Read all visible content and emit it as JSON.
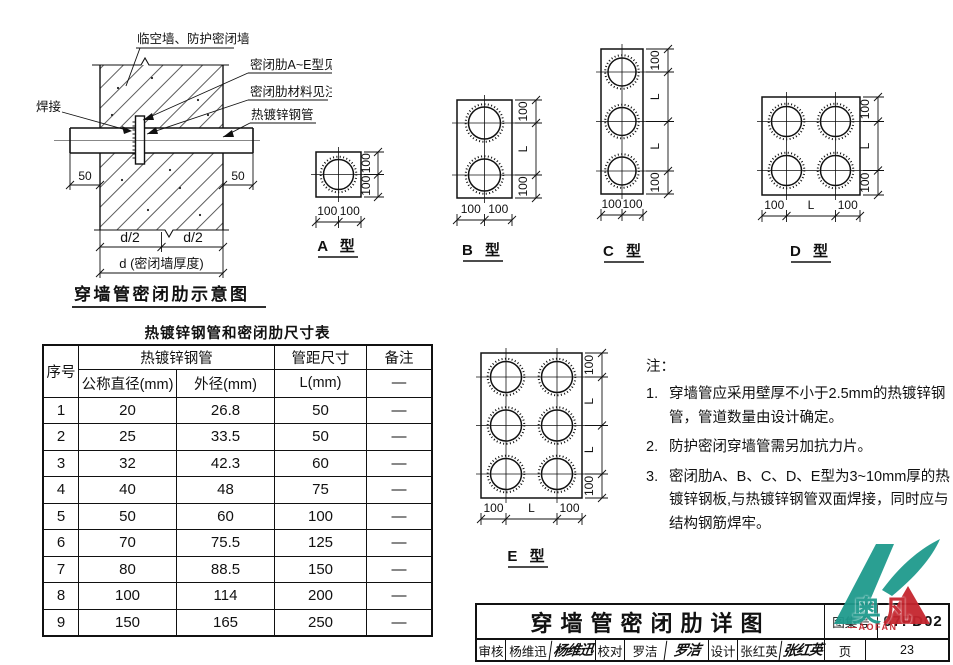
{
  "schematic": {
    "title": "穿墙管密闭肋示意图",
    "label_wall": "临空墙、防护密闭墙",
    "label_weld": "焊接",
    "label_rib": "密闭肋A~E型见图",
    "label_rib_material": "密闭肋材料见注3",
    "label_pipe": "热镀锌钢管",
    "dim_50_left": "50",
    "dim_50_right": "50",
    "dim_d2_left": "d/2",
    "dim_d2_right": "d/2",
    "dim_d": "d (密闭墙厚度)"
  },
  "types": {
    "a": {
      "label": "A 型",
      "bottom": [
        "100",
        "100"
      ],
      "side": [
        "100",
        "100"
      ]
    },
    "b": {
      "label": "B 型",
      "bottom": [
        "100",
        "100"
      ],
      "side": [
        "100",
        "L",
        "100"
      ]
    },
    "c": {
      "label": "C 型",
      "bottom": [
        "100",
        "100"
      ],
      "side": [
        "100",
        "L",
        "L",
        "100"
      ]
    },
    "d": {
      "label": "D 型",
      "bottom": [
        "100",
        "L",
        "100"
      ],
      "side": [
        "100",
        "L",
        "100"
      ]
    },
    "e": {
      "label": "E 型",
      "bottom": [
        "100",
        "L",
        "100"
      ],
      "side": [
        "100",
        "L",
        "L",
        "100"
      ]
    }
  },
  "table": {
    "title": "热镀锌钢管和密闭肋尺寸表",
    "col_seq": "序号",
    "group_pipe": "热镀锌钢管",
    "col_nominal": "公称直径(mm)",
    "col_outer": "外径(mm)",
    "group_spacing": "管距尺寸",
    "col_L": "L(mm)",
    "col_remark": "备注",
    "remark_dash": "—",
    "rows": [
      [
        "1",
        "20",
        "26.8",
        "50",
        "—"
      ],
      [
        "2",
        "25",
        "33.5",
        "50",
        "—"
      ],
      [
        "3",
        "32",
        "42.3",
        "60",
        "—"
      ],
      [
        "4",
        "40",
        "48",
        "75",
        "—"
      ],
      [
        "5",
        "50",
        "60",
        "100",
        "—"
      ],
      [
        "6",
        "70",
        "75.5",
        "125",
        "—"
      ],
      [
        "7",
        "80",
        "88.5",
        "150",
        "—"
      ],
      [
        "8",
        "100",
        "114",
        "200",
        "—"
      ],
      [
        "9",
        "150",
        "165",
        "250",
        "—"
      ]
    ]
  },
  "notes": {
    "heading": "注：",
    "items": [
      {
        "no": "1.",
        "text": "穿墙管应采用壁厚不小于2.5mm的热镀锌钢管，管道数量由设计确定。"
      },
      {
        "no": "2.",
        "text": "防护密闭穿墙管需另加抗力片。"
      },
      {
        "no": "3.",
        "text": "密闭肋A、B、C、D、E型为3~10mm厚的热镀锌钢板,与热镀锌钢管双面焊接，同时应与结构钢筋焊牢。"
      }
    ]
  },
  "titleblock": {
    "drawing_title": "穿墙管密闭肋详图",
    "atlas_label": "图集号",
    "atlas_no": "07FD02",
    "review_label": "审核",
    "review_name": "杨维迅",
    "review_sig": "杨维迅",
    "check_label": "校对",
    "check_name": "罗洁",
    "check_sig": "罗洁",
    "design_label": "设计",
    "design_name": "张红英",
    "design_sig": "张红英",
    "page_label": "页",
    "page_no": "23"
  },
  "watermark": {
    "brand_char_1": "奥",
    "brand_char_2": "凡",
    "brand_sub": "—AOFAN",
    "teal": "#1f9a8d",
    "red": "#c5252e"
  }
}
